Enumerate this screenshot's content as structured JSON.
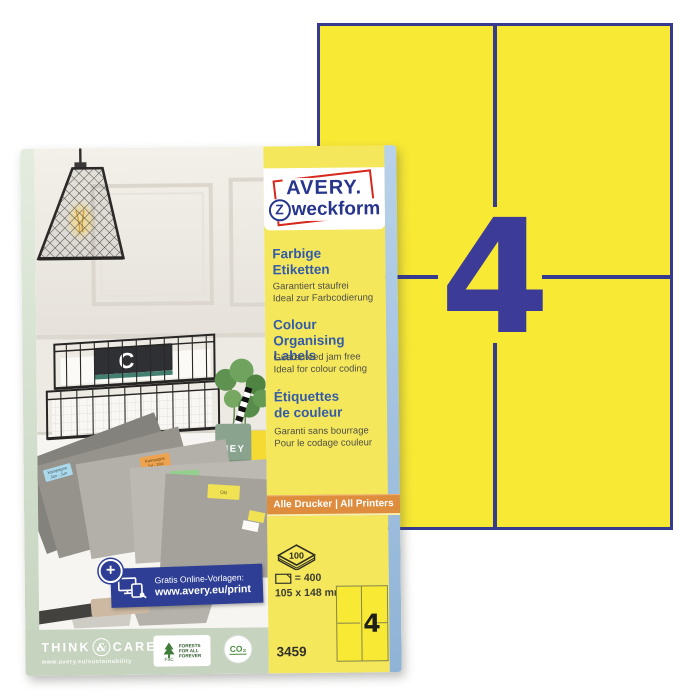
{
  "colors": {
    "sheet_yellow": "#f8e935",
    "panel_yellow": "#f4e75c",
    "divider_blue": "#363b90",
    "number_blue": "#3c3b98",
    "logo_blue": "#27358c",
    "logo_red": "#d6281e",
    "orange_banner": "#de8d3e",
    "side_strip_blue": "#a9c9e9",
    "promo_blue": "#2d3e94",
    "sage_band": "#c6d3bf"
  },
  "sheet": {
    "number": "4"
  },
  "package": {
    "logo": {
      "line1": "AVERY.",
      "line2_initial": "Z",
      "line2_rest": "weckform"
    },
    "blocks": [
      {
        "heading1": "Farbige",
        "heading2": "Etiketten",
        "sub1": "Garantiert staufrei",
        "sub2": "Ideal zur Farbcodierung"
      },
      {
        "heading1": "Colour Organising",
        "heading2": "Labels",
        "sub1": "Guaranteed jam free",
        "sub2": "Ideal for colour coding"
      },
      {
        "heading1": "Étiquettes",
        "heading2": "de couleur",
        "sub1": "Garanti sans bourrage",
        "sub2": "Pour le codage couleur"
      }
    ],
    "printer_banner": "Alle Drucker | All Printers",
    "specs": {
      "sheet_count": "100",
      "label_count": "= 400",
      "label_size": "105 x 148 mm",
      "labels_per_sheet": "4",
      "product_code": "3459"
    },
    "promo": {
      "plus": "+",
      "line1": "Gratis Online-Vorlagen:",
      "line2": "www.avery.eu/print"
    },
    "footer": {
      "think": "THINK",
      "amp": "&",
      "care": "CARE",
      "url": "www.avery.eu/sustainability",
      "fsc_acronym": "FSC",
      "fsc_text": [
        "FORESTS",
        "FOR ALL",
        "FOREVER"
      ],
      "co2": "CO₂"
    },
    "photo": {
      "mug": "HEY",
      "notebook_letter": "C",
      "folder_labels": [
        {
          "line1": "Kampagne",
          "line2": "Jan - Jun"
        },
        {
          "line1": "Kampagne",
          "line2": "Jul - Dez"
        },
        {
          "line1": "Budget",
          "line2": ""
        },
        {
          "line1": "Okt",
          "line2": ""
        }
      ]
    }
  }
}
